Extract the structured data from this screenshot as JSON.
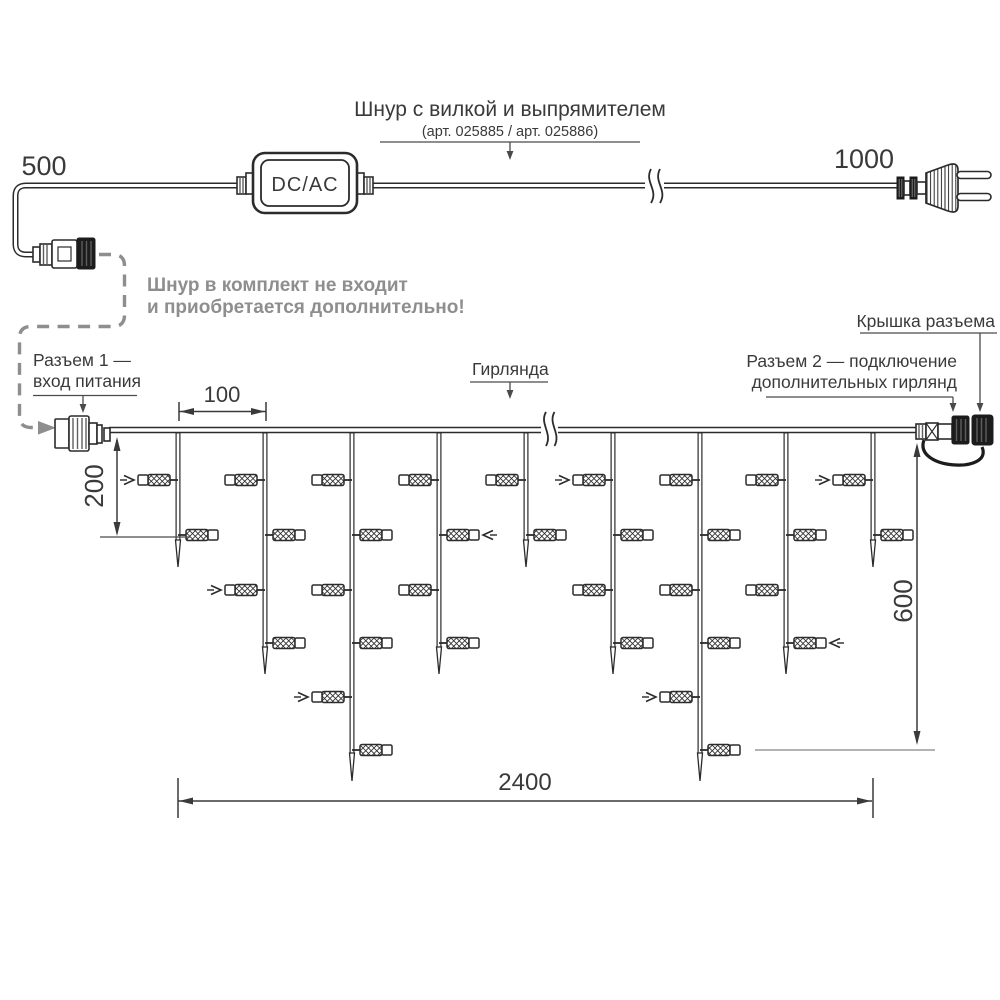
{
  "header": {
    "cord_title": "Шнур с вилкой и выпрямителем",
    "cord_subtitle": "(арт. 025885 / арт. 025886)"
  },
  "notes": {
    "line1": "Шнур в комплект не входит",
    "line2": "и приобретается дополнительно!"
  },
  "labels": {
    "converter": "DC/AC",
    "connector1_line1": "Разъем 1 —",
    "connector1_line2": "вход питания",
    "garland": "Гирлянда",
    "connector2_line1": "Разъем 2 — подключение",
    "connector2_line2": "дополнительных гирлянд",
    "cap": "Крышка разъема"
  },
  "dimensions": {
    "cord_left_mm": "500",
    "cord_right_mm": "1000",
    "drop_spacing_mm": "100",
    "short_drop_mm": "200",
    "long_drop_mm": "600",
    "garland_length_mm": "2400"
  },
  "colors": {
    "line": "#2b2b2b",
    "dim": "#3a3a3a",
    "gray": "#8e8e8e",
    "light_gray": "#9a9a9a"
  },
  "garland_structure": {
    "wire_y": 430,
    "x_start": 109,
    "x_end": 916,
    "break_x": 549,
    "bulb_rows": [
      480,
      535,
      590,
      643,
      697,
      750
    ],
    "drops": [
      {
        "x": 178,
        "line_end": 540,
        "tip": 567,
        "bulbs": [
          {
            "row": 0,
            "side": "L",
            "arrow": true
          },
          {
            "row": 1,
            "side": "R"
          }
        ]
      },
      {
        "x": 265,
        "line_end": 647,
        "tip": 674,
        "bulbs": [
          {
            "row": 0,
            "side": "L"
          },
          {
            "row": 1,
            "side": "R"
          },
          {
            "row": 2,
            "side": "L",
            "arrow": true
          },
          {
            "row": 3,
            "side": "R"
          }
        ]
      },
      {
        "x": 352,
        "line_end": 753,
        "tip": 781,
        "bulbs": [
          {
            "row": 0,
            "side": "L"
          },
          {
            "row": 1,
            "side": "R"
          },
          {
            "row": 2,
            "side": "L"
          },
          {
            "row": 3,
            "side": "R"
          },
          {
            "row": 4,
            "side": "L",
            "arrow": true
          },
          {
            "row": 5,
            "side": "R"
          }
        ]
      },
      {
        "x": 439,
        "line_end": 647,
        "tip": 674,
        "bulbs": [
          {
            "row": 0,
            "side": "L"
          },
          {
            "row": 1,
            "side": "R",
            "arrow": true
          },
          {
            "row": 2,
            "side": "L"
          },
          {
            "row": 3,
            "side": "R"
          }
        ]
      },
      {
        "x": 526,
        "line_end": 540,
        "tip": 567,
        "bulbs": [
          {
            "row": 0,
            "side": "L"
          },
          {
            "row": 1,
            "side": "R"
          }
        ]
      },
      {
        "x": 613,
        "line_end": 647,
        "tip": 674,
        "bulbs": [
          {
            "row": 0,
            "side": "L",
            "arrow": true
          },
          {
            "row": 1,
            "side": "R"
          },
          {
            "row": 2,
            "side": "L"
          },
          {
            "row": 3,
            "side": "R"
          }
        ]
      },
      {
        "x": 700,
        "line_end": 753,
        "tip": 781,
        "bulbs": [
          {
            "row": 0,
            "side": "L"
          },
          {
            "row": 1,
            "side": "R"
          },
          {
            "row": 2,
            "side": "L"
          },
          {
            "row": 3,
            "side": "R"
          },
          {
            "row": 4,
            "side": "L",
            "arrow": true
          },
          {
            "row": 5,
            "side": "R"
          }
        ]
      },
      {
        "x": 786,
        "line_end": 647,
        "tip": 674,
        "bulbs": [
          {
            "row": 0,
            "side": "L"
          },
          {
            "row": 1,
            "side": "R"
          },
          {
            "row": 2,
            "side": "L"
          },
          {
            "row": 3,
            "side": "R",
            "arrow": true
          }
        ]
      },
      {
        "x": 873,
        "line_end": 540,
        "tip": 567,
        "bulbs": [
          {
            "row": 0,
            "side": "L",
            "arrow": true
          },
          {
            "row": 1,
            "side": "R"
          }
        ]
      }
    ]
  }
}
